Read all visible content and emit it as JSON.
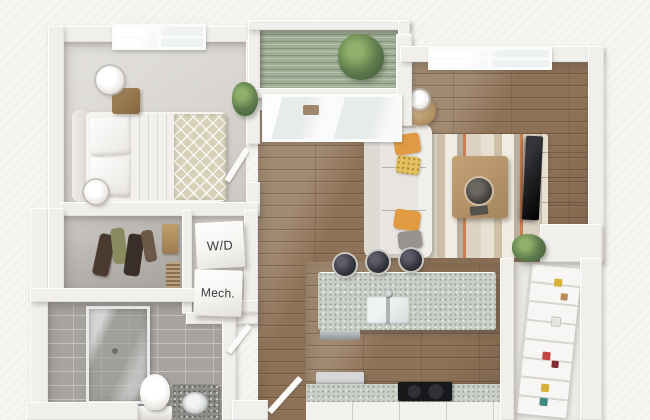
{
  "scene": {
    "description": "3D top-down render of a one-bedroom apartment floor plan",
    "labels": {
      "washer_dryer": "W/D",
      "mechanical": "Mech."
    },
    "palette": {
      "background": "#f6f5f2",
      "wall": "#f1efec",
      "wood_floor": "#8e7257",
      "bedroom_floor": "#dcd9d5",
      "tile_floor": "#a7a4a0",
      "granite": "#c9cec7",
      "balcony_deck": "#9fae95",
      "sofa": "#e8e5e0",
      "accent_pillow": "#e29a42",
      "plant": "#5d7a4c",
      "tv": "#1d1d20",
      "label_text": "#3b3b3b"
    }
  }
}
